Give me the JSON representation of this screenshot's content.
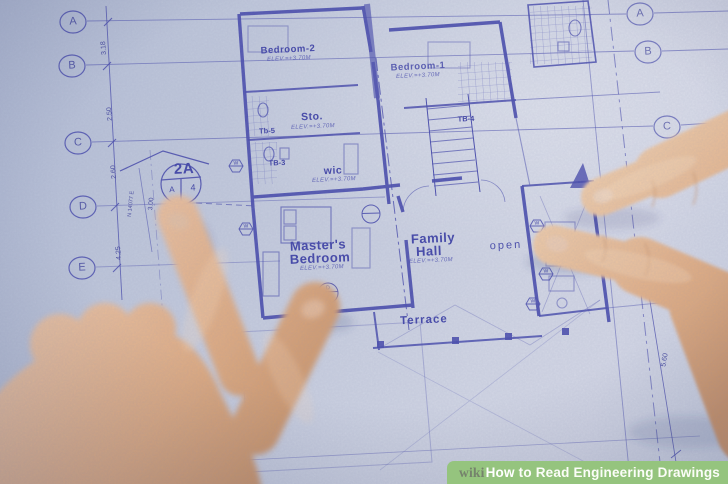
{
  "watermark": {
    "brand": "wiki",
    "title_bold": "How",
    "title_rest": " to Read Engineering Drawings",
    "bar_color": "#95c47e",
    "brand_color": "#75826c",
    "text_color": "#ffffff"
  },
  "blueprint": {
    "ink_color": "#4649ad",
    "paper_color": "#ccd2e2",
    "grid_left": [
      "A",
      "B",
      "C",
      "D",
      "E"
    ],
    "grid_right": [
      "A",
      "B",
      "C"
    ],
    "dims_left": [
      "3.18",
      "2.50",
      "2.60",
      "4.25"
    ],
    "dim_right": "5.60",
    "dim_callout": "3.00",
    "bearing": "N 14077 E",
    "callout": {
      "code": "2A",
      "sheet_left": "A",
      "sheet_right": "4"
    },
    "rooms": {
      "bedroom2": {
        "name": "Bedroom-2",
        "elev": "ELEV.=+3.70M"
      },
      "bedroom1": {
        "name": "Bedroom-1",
        "elev": "ELEV.=+3.70M"
      },
      "sto": {
        "name": "Sto.",
        "elev": "ELEV.=+3.70M"
      },
      "wic": {
        "name": "wic",
        "elev": "ELEV.=+3.70M"
      },
      "master": {
        "line1": "Master's",
        "line2": "Bedroom",
        "elev": "ELEV.=+3.70M"
      },
      "family": {
        "line1": "Family",
        "line2": "Hall",
        "elev": "ELEV.=+3.70M"
      },
      "open": {
        "name": "open"
      },
      "terrace": {
        "name": "Terrace"
      },
      "terrace2": {
        "name": "Terrace"
      }
    },
    "tags": {
      "tb5": "Tb-5",
      "tb3": "TB-3",
      "tb4": "TB-4"
    },
    "window_tag": "W",
    "door_circle": {
      "top": "D",
      "bottom": "6"
    }
  }
}
